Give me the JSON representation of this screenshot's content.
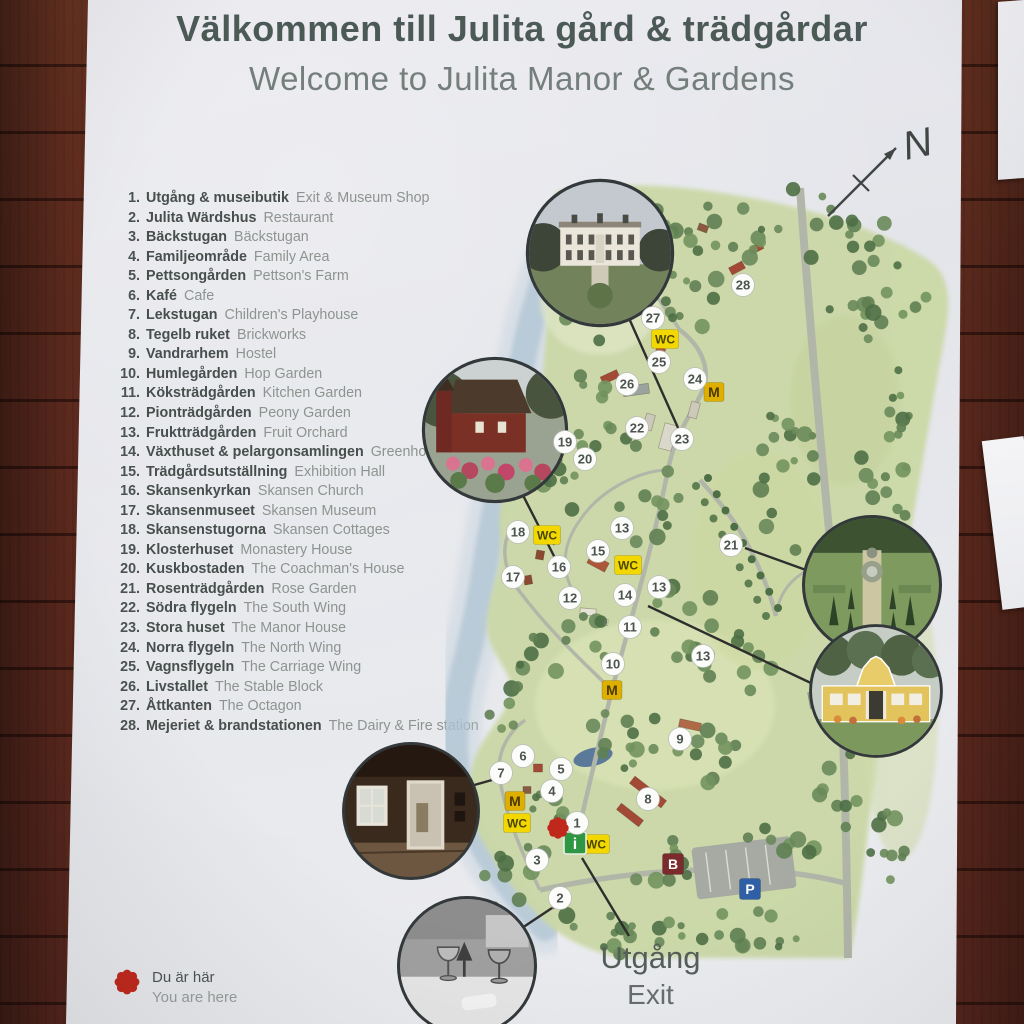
{
  "sign": {
    "title_sv": "Välkommen till Julita gård & trädgårdar",
    "title_en": "Welcome to Julita Manor & Gardens",
    "compass_n": "N",
    "exit": {
      "sv": "Utgång",
      "en": "Exit"
    },
    "you_are_here": {
      "sv": "Du är här",
      "en": "You are here"
    },
    "legend": [
      {
        "num": 1,
        "sv": "Utgång & museibutik",
        "en": "Exit & Museum Shop"
      },
      {
        "num": 2,
        "sv": "Julita Wärdshus",
        "en": "Restaurant"
      },
      {
        "num": 3,
        "sv": "Bäckstugan",
        "en": "Bäckstugan"
      },
      {
        "num": 4,
        "sv": "Familjeområde",
        "en": "Family Area"
      },
      {
        "num": 5,
        "sv": "Pettsongården",
        "en": "Pettson's Farm"
      },
      {
        "num": 6,
        "sv": "Kafé",
        "en": "Cafe"
      },
      {
        "num": 7,
        "sv": "Lekstugan",
        "en": "Children's Playhouse"
      },
      {
        "num": 8,
        "sv": "Tegelb ruket",
        "en": "Brickworks"
      },
      {
        "num": 9,
        "sv": "Vandrarhem",
        "en": "Hostel"
      },
      {
        "num": 10,
        "sv": "Humlegården",
        "en": "Hop Garden"
      },
      {
        "num": 11,
        "sv": "Köksträdgården",
        "en": "Kitchen Garden"
      },
      {
        "num": 12,
        "sv": "Pionträdgården",
        "en": "Peony Garden"
      },
      {
        "num": 13,
        "sv": "Fruktträdgården",
        "en": "Fruit Orchard"
      },
      {
        "num": 14,
        "sv": "Växthuset & pelargonsamlingen",
        "en": "Greenhouse"
      },
      {
        "num": 15,
        "sv": "Trädgårdsutställning",
        "en": "Exhibition Hall"
      },
      {
        "num": 16,
        "sv": "Skansenkyrkan",
        "en": "Skansen Church"
      },
      {
        "num": 17,
        "sv": "Skansenmuseet",
        "en": "Skansen Museum"
      },
      {
        "num": 18,
        "sv": "Skansenstugorna",
        "en": "Skansen Cottages"
      },
      {
        "num": 19,
        "sv": "Klosterhuset",
        "en": "Monastery House"
      },
      {
        "num": 20,
        "sv": "Kuskbostaden",
        "en": "The Coachman's House"
      },
      {
        "num": 21,
        "sv": "Rosenträdgården",
        "en": "Rose Garden"
      },
      {
        "num": 22,
        "sv": "Södra flygeln",
        "en": "The South Wing"
      },
      {
        "num": 23,
        "sv": "Stora huset",
        "en": "The Manor House"
      },
      {
        "num": 24,
        "sv": "Norra flygeln",
        "en": "The North Wing"
      },
      {
        "num": 25,
        "sv": "Vagnsflygeln",
        "en": "The Carriage Wing"
      },
      {
        "num": 26,
        "sv": "Livstallet",
        "en": "The Stable Block"
      },
      {
        "num": 27,
        "sv": "Åttkanten",
        "en": "The Octagon"
      },
      {
        "num": 28,
        "sv": "Mejeriet & brandstationen",
        "en": "The Dairy & Fire station"
      }
    ]
  },
  "map": {
    "colors": {
      "wall": "#5d2a1e",
      "marker_red": "#c1281c",
      "wc_yellow": "#f2d800",
      "m_mustard": "#dfaf00",
      "info_green": "#2f9643",
      "bus_red": "#7c2b2d",
      "parking_blue": "#2f5fa5",
      "land_green": "#cbd8a6",
      "water_blue": "#b7cad8"
    },
    "markers": [
      {
        "n": "28",
        "x": 743,
        "y": 285
      },
      {
        "n": "27",
        "x": 653,
        "y": 318
      },
      {
        "n": "25",
        "x": 659,
        "y": 362
      },
      {
        "n": "26",
        "x": 627,
        "y": 384
      },
      {
        "n": "24",
        "x": 695,
        "y": 379
      },
      {
        "n": "22",
        "x": 637,
        "y": 428
      },
      {
        "n": "23",
        "x": 682,
        "y": 439
      },
      {
        "n": "19",
        "x": 565,
        "y": 442
      },
      {
        "n": "20",
        "x": 585,
        "y": 459
      },
      {
        "n": "18",
        "x": 518,
        "y": 532
      },
      {
        "n": "13",
        "x": 622,
        "y": 528
      },
      {
        "n": "15",
        "x": 598,
        "y": 551
      },
      {
        "n": "16",
        "x": 559,
        "y": 567
      },
      {
        "n": "17",
        "x": 513,
        "y": 577
      },
      {
        "n": "12",
        "x": 570,
        "y": 598
      },
      {
        "n": "14",
        "x": 625,
        "y": 595
      },
      {
        "n": "13",
        "x": 659,
        "y": 587
      },
      {
        "n": "11",
        "x": 630,
        "y": 627
      },
      {
        "n": "10",
        "x": 613,
        "y": 664
      },
      {
        "n": "13",
        "x": 703,
        "y": 656
      },
      {
        "n": "21",
        "x": 731,
        "y": 545
      },
      {
        "n": "9",
        "x": 680,
        "y": 739
      },
      {
        "n": "6",
        "x": 523,
        "y": 756
      },
      {
        "n": "7",
        "x": 501,
        "y": 773
      },
      {
        "n": "5",
        "x": 561,
        "y": 769
      },
      {
        "n": "4",
        "x": 552,
        "y": 791
      },
      {
        "n": "1",
        "x": 577,
        "y": 823
      },
      {
        "n": "3",
        "x": 537,
        "y": 860
      },
      {
        "n": "8",
        "x": 648,
        "y": 799
      },
      {
        "n": "2",
        "x": 560,
        "y": 898
      }
    ],
    "badges": [
      {
        "t": "WC",
        "x": 665,
        "y": 339
      },
      {
        "t": "WC",
        "x": 547,
        "y": 535
      },
      {
        "t": "WC",
        "x": 628,
        "y": 565
      },
      {
        "t": "WC",
        "x": 517,
        "y": 823
      },
      {
        "t": "WC",
        "x": 596,
        "y": 844
      },
      {
        "t": "M",
        "x": 714,
        "y": 392
      },
      {
        "t": "M",
        "x": 612,
        "y": 690
      },
      {
        "t": "M",
        "x": 515,
        "y": 801
      },
      {
        "t": "i",
        "x": 575,
        "y": 843
      },
      {
        "t": "B",
        "x": 673,
        "y": 864
      },
      {
        "t": "P",
        "x": 750,
        "y": 889
      }
    ],
    "you_are_here_dot": {
      "x": 558,
      "y": 828
    },
    "photos": [
      {
        "name": "manor",
        "x": 600,
        "y": 253,
        "r": 71
      },
      {
        "name": "church",
        "x": 495,
        "y": 430,
        "r": 70
      },
      {
        "name": "garden",
        "x": 872,
        "y": 585,
        "r": 67
      },
      {
        "name": "greenhouse",
        "x": 876,
        "y": 691,
        "r": 64
      },
      {
        "name": "interior",
        "x": 411,
        "y": 811,
        "r": 66
      },
      {
        "name": "restaurant",
        "x": 467,
        "y": 966,
        "r": 67
      }
    ],
    "connectors": [
      {
        "x1": 628,
        "y1": 316,
        "x2": 679,
        "y2": 430
      },
      {
        "x1": 506,
        "y1": 462,
        "x2": 556,
        "y2": 560
      },
      {
        "x1": 745,
        "y1": 548,
        "x2": 806,
        "y2": 570
      },
      {
        "x1": 648,
        "y1": 606,
        "x2": 813,
        "y2": 684
      },
      {
        "x1": 446,
        "y1": 793,
        "x2": 492,
        "y2": 780
      },
      {
        "x1": 504,
        "y1": 940,
        "x2": 552,
        "y2": 908
      },
      {
        "x1": 582,
        "y1": 858,
        "x2": 629,
        "y2": 936
      }
    ]
  }
}
